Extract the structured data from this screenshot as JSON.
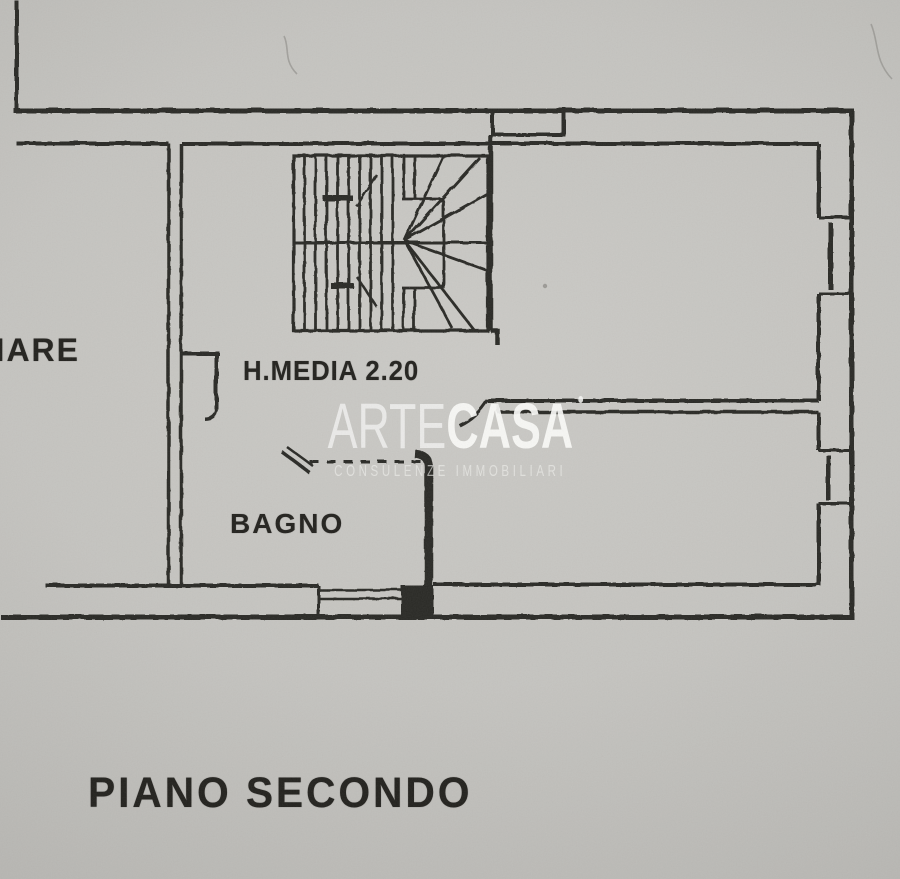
{
  "document": {
    "kind": "real-estate floor plan scan",
    "plan_title": "PIANO SECONDO",
    "labels": {
      "left_room_partial": "LIARE",
      "height_note": "H.MEDIA 2.20",
      "bathroom": "BAGNO"
    },
    "watermark": {
      "brand_thin": "ARTE",
      "brand_bold": "CASA",
      "tagline": "CONSULENZE IMMOBILIARI"
    },
    "colors": {
      "paper_light": "#cbcac6",
      "paper_dark": "#a7a6a2",
      "ink": "#2b2a26",
      "watermark_white": "#f5f5f3"
    }
  }
}
